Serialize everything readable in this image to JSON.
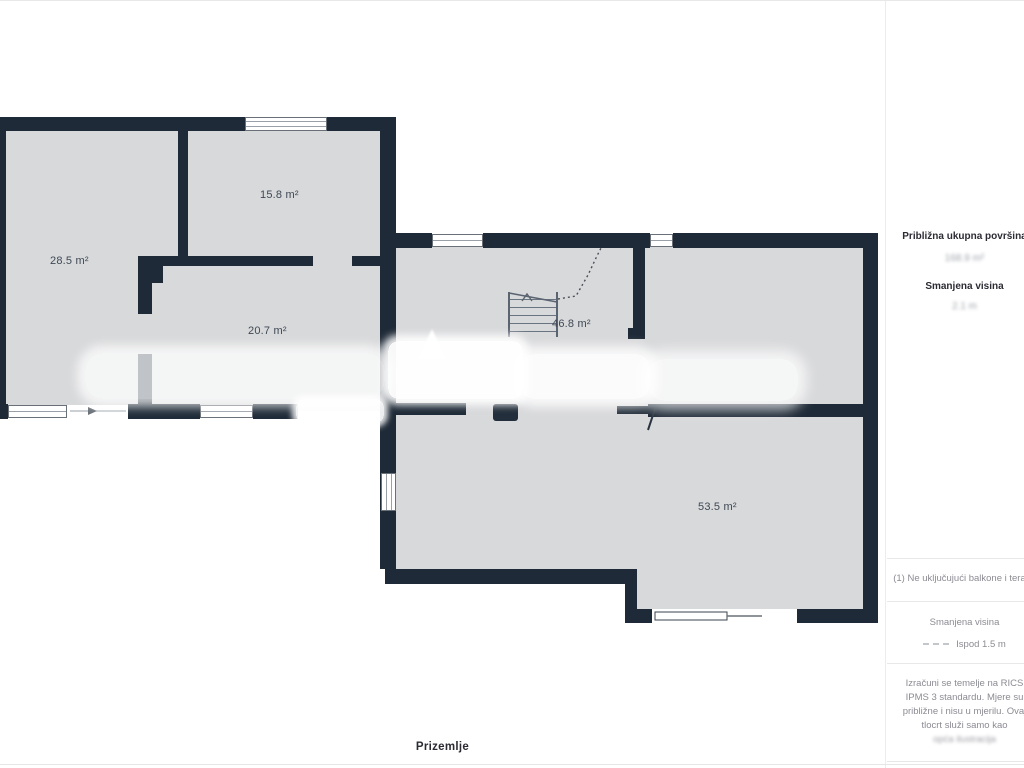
{
  "plan": {
    "floor_label": "Prizemlje",
    "rooms": [
      {
        "name": "room-28-5",
        "area_label": "28.5 m²"
      },
      {
        "name": "room-15-8",
        "area_label": "15.8 m²"
      },
      {
        "name": "room-20-7",
        "area_label": "20.7 m²"
      },
      {
        "name": "room-46-8",
        "area_label": "46.8 m²"
      },
      {
        "name": "room-53-5",
        "area_label": "53.5 m²"
      }
    ],
    "colors": {
      "wall": "#1e2a37",
      "floor": "#d8d9db",
      "background": "#ffffff"
    }
  },
  "sidebar": {
    "total_area_heading": "Približna ukupna površina",
    "total_area_value_blurred": "168.9 m²",
    "reduced_height_heading": "Smanjena visina",
    "reduced_height_value_blurred": "2.1 m",
    "footnote": "(1) Ne uključujući balkone i terase",
    "legend": {
      "label": "Smanjena visina",
      "item": "Ispod 1.5 m",
      "icon": "dashed-line-icon"
    },
    "disclaimer": "Izračuni se temelje na RICS IPMS 3 standardu. Mjere su približne i nisu u mjerilu. Ovaj tlocrt služi samo kao",
    "disclaimer_blurred": "opća ilustracija"
  }
}
